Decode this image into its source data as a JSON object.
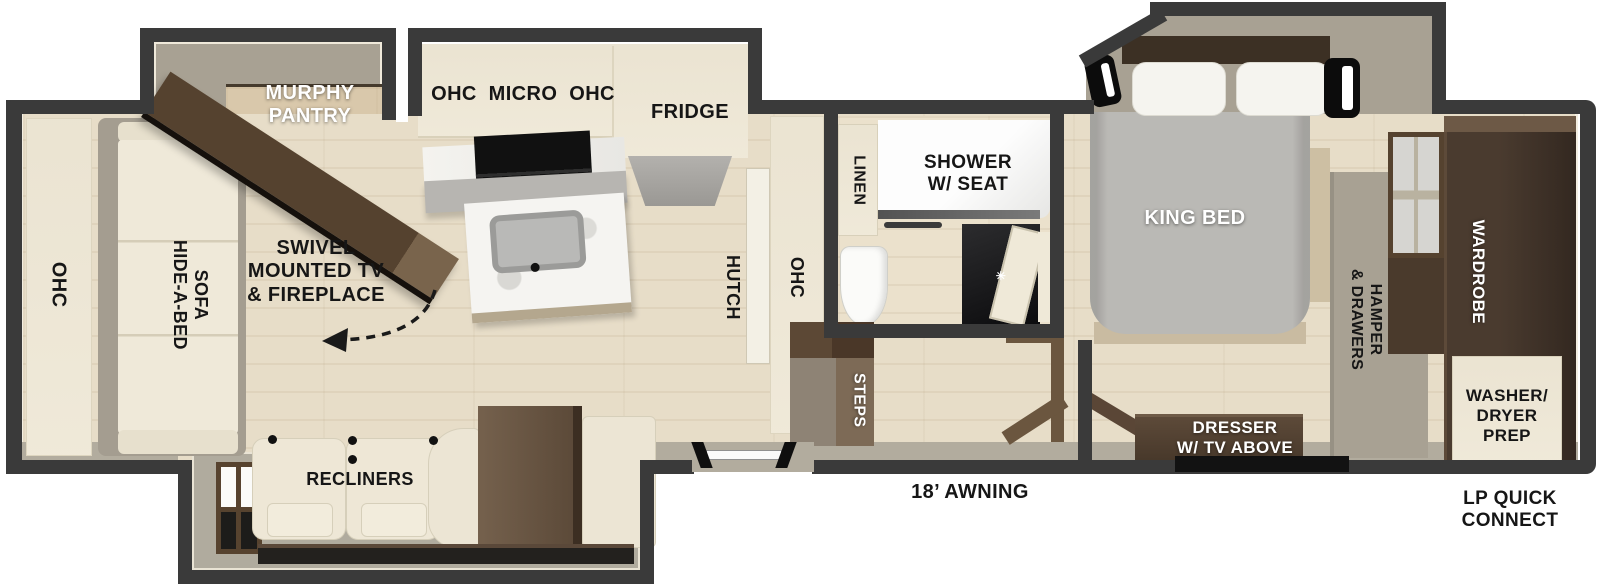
{
  "title": "RV travel trailer floor plan",
  "colors": {
    "wall": "#3a3a3a",
    "floor": "#e7ddc8",
    "floor_bath": "#ebe1cc",
    "cream": "#f1ebdb",
    "cream_dark": "#e4dcc6",
    "gray_slide": "#a8a193",
    "gray_band": "#b2ac9e",
    "dark_wood": "#47382a",
    "mid_wood": "#6e5b49",
    "step_brown": "#7d6a56",
    "step_taupe": "#8e8375",
    "rail_brown": "#6b563f",
    "bed_gray": "#bab9b5",
    "pillow_white": "#f5f4ef",
    "black": "#161616",
    "tan": "#c9bba1"
  },
  "labels": {
    "rear_ohc": "OHC",
    "sofa": [
      "HIDE-A-BED",
      "SOFA"
    ],
    "murphy": [
      "MURPHY",
      "PANTRY"
    ],
    "swivel": [
      "SWIVEL",
      "MOUNTED TV",
      "& FIREPLACE"
    ],
    "kitchen_ohc": "OHC  MICRO  OHC",
    "fridge": "FRIDGE",
    "hutch": "HUTCH",
    "hutch_ohc": "OHC",
    "linen": "LINEN",
    "shower": [
      "SHOWER",
      "W/ SEAT"
    ],
    "steps": "STEPS",
    "recliners": "RECLINERS",
    "king_bed": "KING BED",
    "dresser": [
      "DRESSER",
      "W/ TV ABOVE"
    ],
    "hamper": [
      "HAMPER",
      "& DRAWERS"
    ],
    "wardrobe": "WARDROBE",
    "washer": [
      "WASHER/",
      "DRYER",
      "PREP"
    ],
    "awning": "18’ AWNING",
    "lp": [
      "LP QUICK",
      "CONNECT"
    ]
  },
  "icons": {
    "vanity_fan": "✳"
  }
}
